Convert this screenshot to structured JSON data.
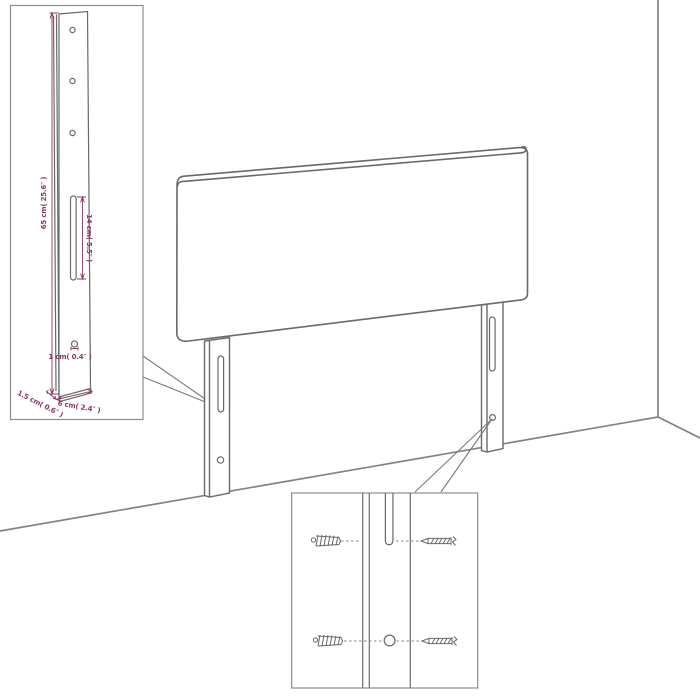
{
  "bracket_inset": {
    "height_label": "65 cm( 25.6″ )",
    "slot_label": "14 cm( 5.5″ )",
    "hole_label": "1 cm( 0.4″ )",
    "depth_label": "1.5 cm( 0.6″ )",
    "width_label": "6 cm( 2.4″ )"
  },
  "colors": {
    "dimension": "#8a3766",
    "drawing_line": "#696969",
    "room_line": "#828282",
    "background": "#ffffff"
  }
}
